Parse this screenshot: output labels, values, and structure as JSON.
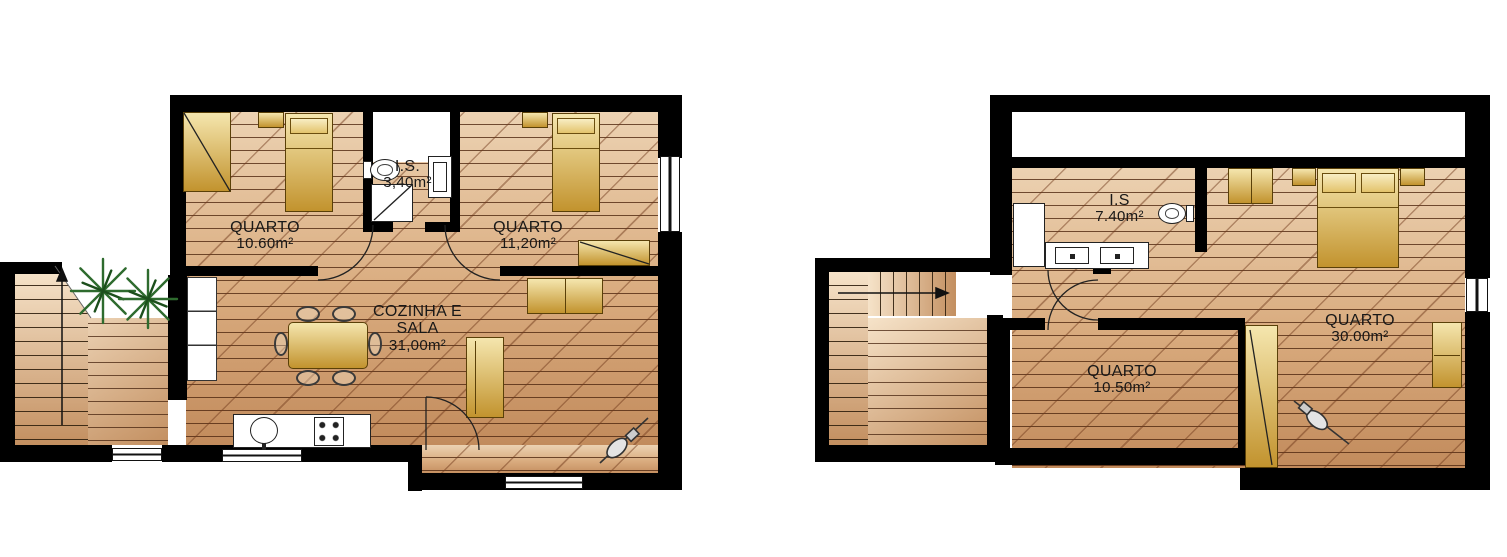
{
  "drawing": {
    "type": "architectural floor plan",
    "language": "pt",
    "units": "m²"
  },
  "colors": {
    "wall": "#000000",
    "background": "#ffffff",
    "floor_light": "#ecd2b2",
    "floor_mid": "#d9ab7e",
    "floor_dark": "#c28b5c",
    "deck_light": "#f6e3c9",
    "deck_dark": "#c38f60",
    "furniture_light": "#f5e6ae",
    "furniture_dark": "#c2932e",
    "plant": "#2e6b2e",
    "line": "#222222"
  },
  "plans": [
    {
      "id": "ground-floor",
      "rooms": [
        {
          "name": "QUARTO",
          "area": "10.60m²"
        },
        {
          "name": "I.S.",
          "area": "3,40m²"
        },
        {
          "name": "QUARTO",
          "area": "11,20m²"
        },
        {
          "name_lines": [
            "COZINHA E",
            "SALA"
          ],
          "area": "31,00m²"
        }
      ]
    },
    {
      "id": "upper-floor",
      "rooms": [
        {
          "name": "I.S",
          "area": "7.40m²"
        },
        {
          "name": "QUARTO",
          "area": "30.00m²"
        },
        {
          "name": "QUARTO",
          "area": "10.50m²"
        }
      ]
    }
  ]
}
